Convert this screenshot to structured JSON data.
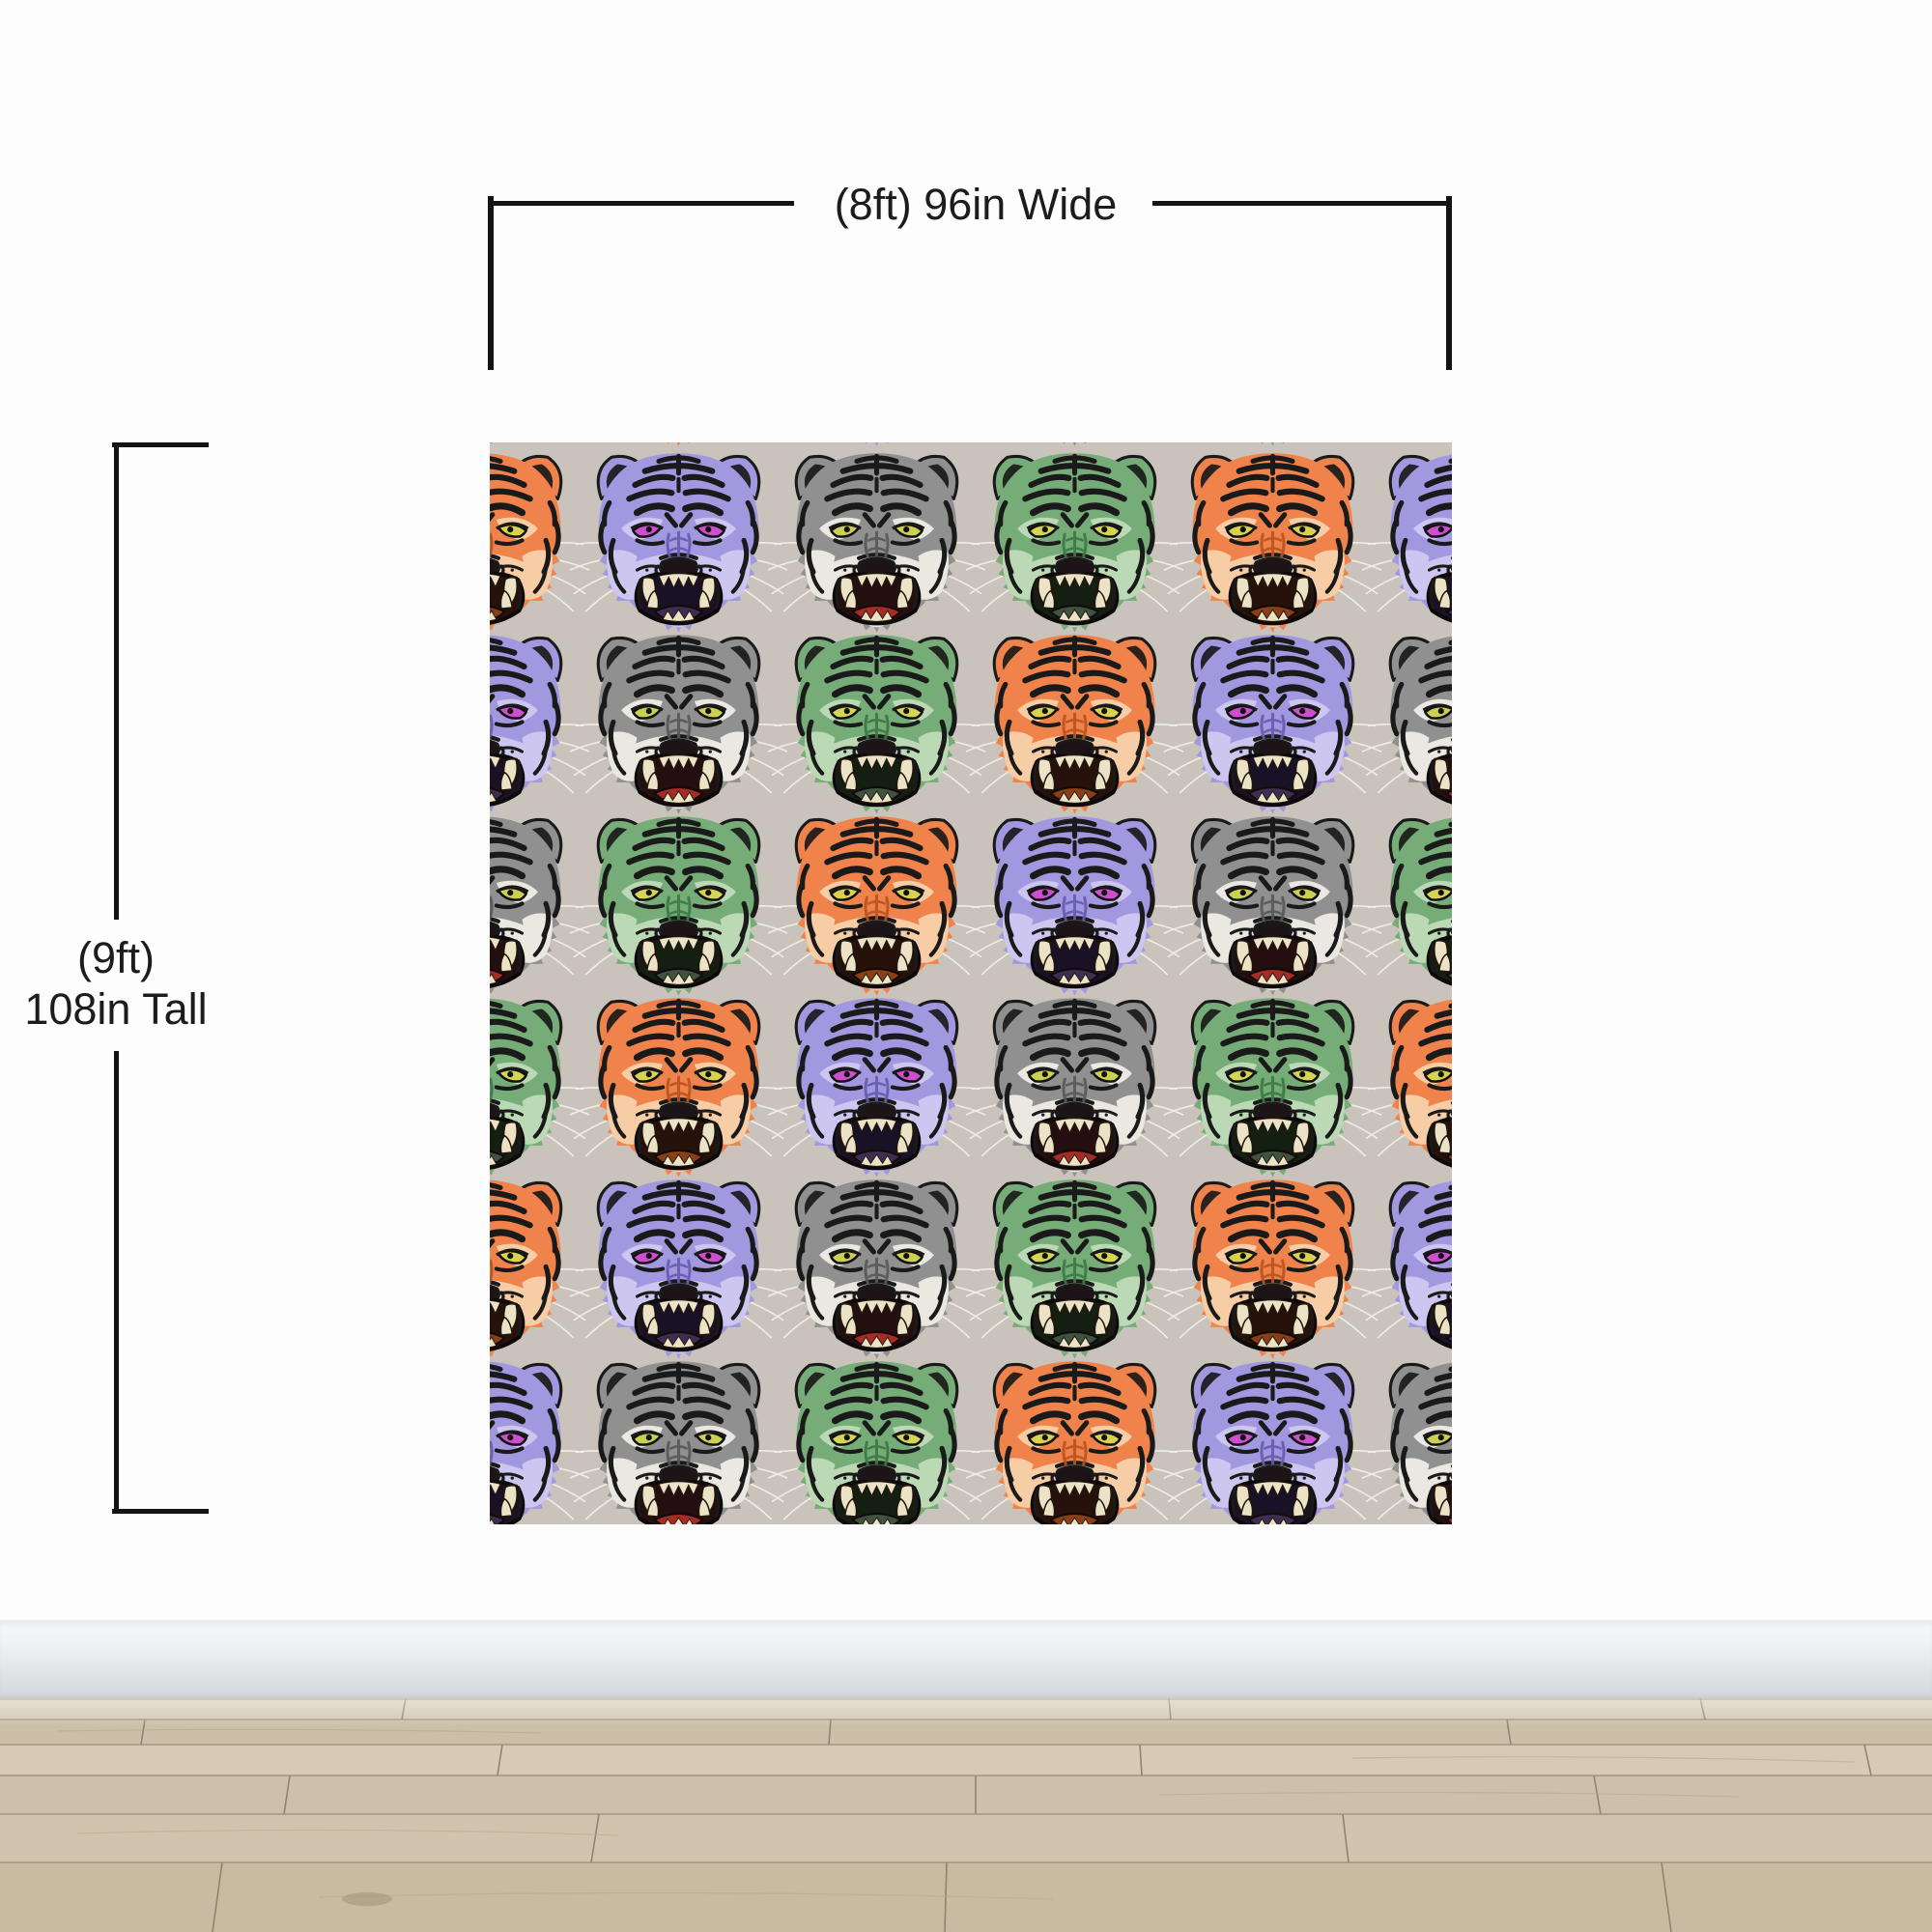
{
  "scene": {
    "description": "Wallpaper mural size mockup on a white wall with baseboard and wood floor",
    "wall_color": "#fdfdfd",
    "baseboard_top_color": "#f7f8f9",
    "baseboard_bottom_color": "#d2d6d9",
    "floor_base_color": "#cec1aa",
    "floor_seam_color": "#8f8472"
  },
  "dimensions": {
    "width_label": "(8ft) 96in Wide",
    "height_label_line1": "(9ft)",
    "height_label_line2": "108in Tall",
    "line_color": "#141414",
    "text_color": "#1c1c1c"
  },
  "mural": {
    "motif": "roaring-tiger-face",
    "background_color": "#c9c3bb",
    "stripe_color": "#1a1a1a",
    "teeth_color": "#ece3c6",
    "whisker_color": "#f2efe7",
    "grid": {
      "columns": 6,
      "rows": 6,
      "top_edge_peek": true
    },
    "pattern_rows": [
      [
        "green",
        "orange",
        "purple",
        "gray",
        "green",
        "orange"
      ],
      [
        "orange",
        "purple",
        "gray",
        "green",
        "orange",
        "purple"
      ],
      [
        "purple",
        "gray",
        "green",
        "orange",
        "purple",
        "gray"
      ],
      [
        "gray",
        "green",
        "orange",
        "purple",
        "gray",
        "green"
      ],
      [
        "green",
        "orange",
        "purple",
        "gray",
        "green",
        "orange"
      ],
      [
        "orange",
        "purple",
        "gray",
        "green",
        "orange",
        "purple"
      ],
      [
        "purple",
        "gray",
        "green",
        "orange",
        "purple",
        "gray"
      ]
    ],
    "variants": {
      "orange": {
        "fur": "#f0824c",
        "muzzle": "#f7cda6",
        "shade": "#b9541f",
        "eye": "#d8d24e",
        "tongue": "#8a3f16",
        "mouth": "#26120a"
      },
      "purple": {
        "fur": "#a298e0",
        "muzzle": "#cdc6f0",
        "shade": "#685bb0",
        "eye": "#cf4ecf",
        "tongue": "#3c2f52",
        "mouth": "#191226"
      },
      "gray": {
        "fur": "#909090",
        "muzzle": "#eae8e0",
        "shade": "#58585a",
        "eye": "#ccd052",
        "tongue": "#a72c26",
        "mouth": "#240e10"
      },
      "green": {
        "fur": "#76ac78",
        "muzzle": "#bcd9b6",
        "shade": "#3b7a44",
        "eye": "#d4d455",
        "tongue": "#3e5340",
        "mouth": "#131f10"
      }
    }
  }
}
